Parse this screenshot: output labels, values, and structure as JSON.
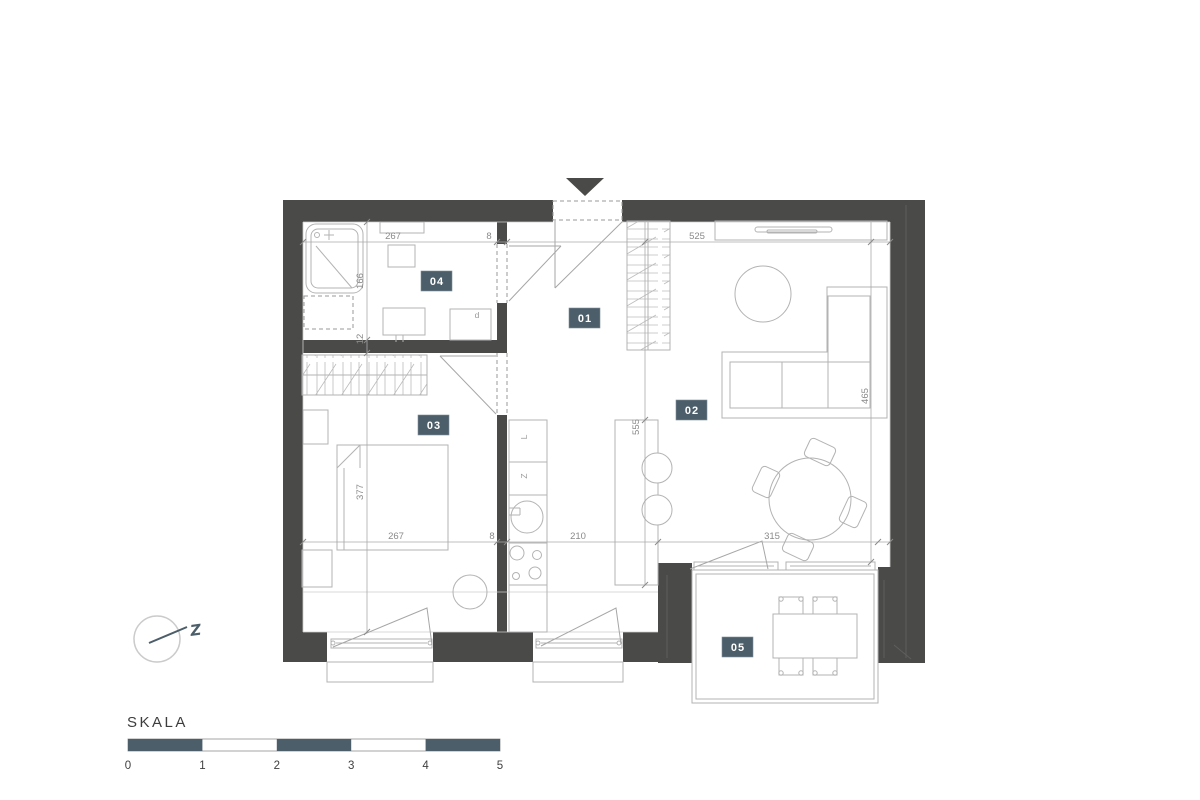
{
  "colors": {
    "wall": "#4a4a48",
    "accent": "#4c5e6a",
    "furniture_line": "#b3b3b3",
    "dim_text": "#8a8a8a"
  },
  "rooms": [
    {
      "id": "01"
    },
    {
      "id": "02"
    },
    {
      "id": "03"
    },
    {
      "id": "04"
    },
    {
      "id": "05"
    }
  ],
  "dimensions": {
    "top": [
      "267",
      "8",
      "525"
    ],
    "bottom": [
      "267",
      "8",
      "210",
      "315"
    ],
    "left": [
      "166",
      "12",
      "377"
    ],
    "kitchen": "555",
    "right": "465"
  },
  "appliances": {
    "fridge": "L",
    "dishwasher": "Z",
    "washer": "d"
  },
  "compass": {
    "label": "Z"
  },
  "scale_bar": {
    "title": "SKALA",
    "ticks": [
      "0",
      "1",
      "2",
      "3",
      "4",
      "5"
    ]
  }
}
